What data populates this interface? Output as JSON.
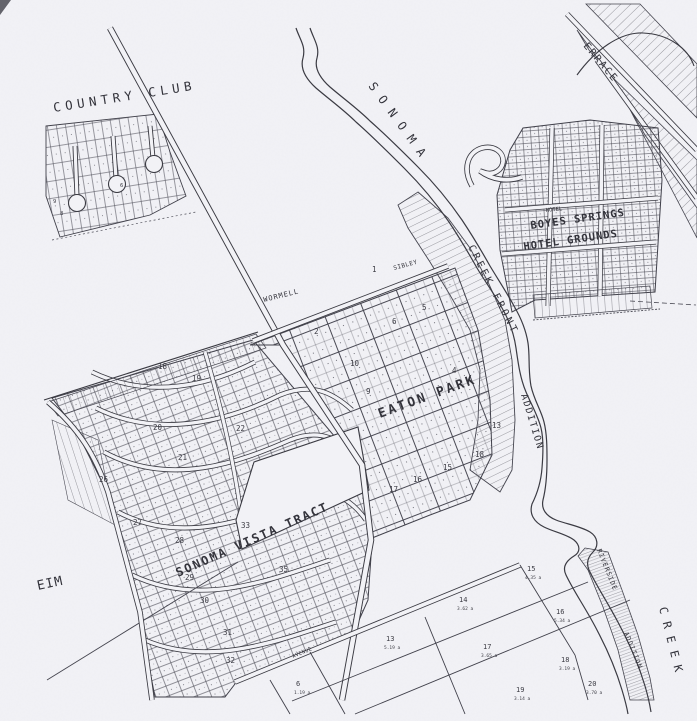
{
  "colors": {
    "paper": "#f2f2f6",
    "ink": "#3a3a42",
    "ink_light": "#5a5a64"
  },
  "country_club": {
    "name": "COUNTRY CLUB",
    "lot_numbers": [
      "9",
      "8",
      "6"
    ]
  },
  "creek": {
    "name": "SONOMA",
    "word": "CREEK"
  },
  "boyes_springs": {
    "line1": "BOYES SPRINGS",
    "line2": "HOTEL GROUNDS",
    "hotel": "HOTEL"
  },
  "eaton_park": {
    "name": "EATON PARK",
    "block_numbers": [
      "1",
      "2",
      "4",
      "5",
      "6",
      "9",
      "10",
      "13",
      "15",
      "16",
      "17",
      "18"
    ]
  },
  "sonoma_vista": {
    "name": "SONOMA VISTA TRACT",
    "block_numbers": [
      "18",
      "19",
      "20",
      "21",
      "22",
      "26",
      "27",
      "28",
      "29",
      "30",
      "31",
      "32",
      "33",
      "35"
    ]
  },
  "streets": {
    "wormell": "WORMELL",
    "sibley": "SIBLEY",
    "avenue": "AVENUE",
    "terrace": "ERRACE",
    "creek_front": "CREEK FRONT",
    "addition": "ADDITION",
    "riverside": "RIVERSIDE",
    "riverside_addition": "ADDITION",
    "eim": "EIM"
  },
  "parcels": [
    {
      "num": "13",
      "acres": "5.19 a"
    },
    {
      "num": "14",
      "acres": "3.62 a"
    },
    {
      "num": "15",
      "acres": "4.35 a"
    },
    {
      "num": "16",
      "acres": "5.34 a"
    },
    {
      "num": "17",
      "acres": "3.65 a"
    },
    {
      "num": "18",
      "acres": "3.19 a"
    },
    {
      "num": "19",
      "acres": "3.14 a"
    },
    {
      "num": "20",
      "acres": "3.70 a"
    },
    {
      "num": "6",
      "acres": "1.19 a"
    }
  ]
}
